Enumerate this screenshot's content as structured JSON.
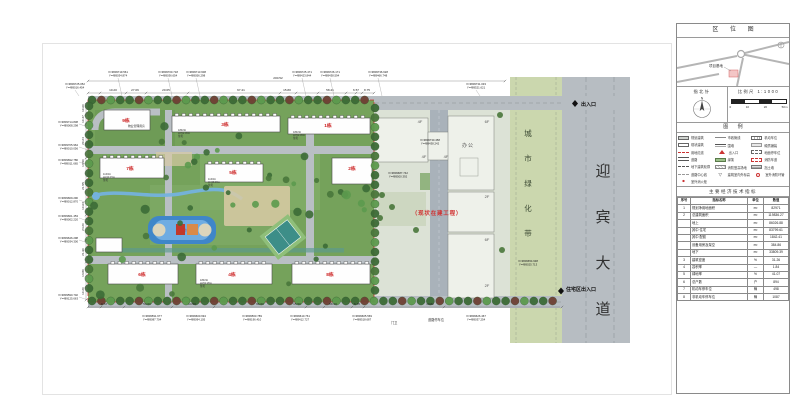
{
  "colors": {
    "site_green": "#75a25b",
    "site_green_light": "#86b16d",
    "road_gray": "#b7bdc2",
    "belt_green": "#cbd7ae",
    "exist_bg": "#dce2d6",
    "exist_bldg": "#eef1ea",
    "water_blue": "#3f86c9",
    "water_light": "#6face2",
    "court_teal": "#3d8e88",
    "court_green": "#8fbf7a",
    "boundary_red": "#cc3333",
    "label_red": "#cc2222",
    "note_red": "#d03030",
    "building_white": "#fefefe",
    "plaza_tan": "#d9caa5",
    "stream_blue": "#74b2de",
    "tree_dark": "#3c6b36",
    "tree_mid": "#49773b",
    "tree_light": "#5c9a4e",
    "tree_maroon": "#6e4034"
  },
  "titleblock": {
    "location_map_title": "区 位 图",
    "site_marker_label": "项目基地",
    "compass_title": "指北针",
    "north_letter": "N",
    "scale_title": "比例尺 1:1000",
    "scale_ticks": [
      "0",
      "10",
      "20",
      "50m"
    ],
    "legend_title": "图  例",
    "legend_columns": [
      [
        {
          "label": "规划建筑",
          "sym": "plan"
        },
        {
          "label": "现状建筑",
          "sym": "exist"
        },
        {
          "label": "用地红线",
          "sym": "redline"
        },
        {
          "label": "道路",
          "sym": "road"
        },
        {
          "label": "地下建筑轮廓",
          "sym": "under"
        },
        {
          "label": "道路中心线",
          "sym": "center"
        },
        {
          "label": "室外消火栓",
          "sym": "hydrant"
        }
      ],
      [
        {
          "label": "市政管线",
          "sym": "muni"
        },
        {
          "label": "围墙",
          "sym": "wall"
        },
        {
          "label": "出入口",
          "sym": "entry"
        },
        {
          "label": "绿篱",
          "sym": "hedge"
        },
        {
          "label": "消防登高场地",
          "sym": "fireground"
        },
        {
          "label": "建筑室内外标高",
          "sym": "level"
        }
      ],
      [
        {
          "label": "机动车位",
          "sym": "park"
        },
        {
          "label": "硬质铺装",
          "sym": "pave"
        },
        {
          "label": "地面停车位",
          "sym": "roadpark"
        },
        {
          "label": "消防车道",
          "sym": "firelane"
        },
        {
          "label": "挡土墙",
          "sym": "retain"
        },
        {
          "label": "室外消防环管",
          "sym": "ring"
        }
      ]
    ],
    "indicators_title": "主要经济技术指标",
    "indicators_header": [
      "序号",
      "指标名称",
      "单位",
      "数值"
    ],
    "indicators_rows": [
      [
        "1",
        "规划净用地面积",
        "m²",
        "82971"
      ],
      [
        "2",
        "总建筑面积",
        "m²",
        "119836.27"
      ],
      [
        "",
        "地上",
        "m²",
        "86026.88"
      ],
      [
        "",
        "其中 住宅",
        "m²",
        "83799.61"
      ],
      [
        "",
        "其中 配套",
        "m²",
        "1842.41"
      ],
      [
        "",
        "设备用房及架空",
        "m²",
        "384.86"
      ],
      [
        "",
        "地下",
        "m²",
        "33809.39"
      ],
      [
        "3",
        "建筑密度",
        "%",
        "31.26"
      ],
      [
        "4",
        "容积率",
        "—",
        "1.84"
      ],
      [
        "5",
        "绿地率",
        "%",
        "41.07"
      ],
      [
        "6",
        "总户数",
        "户",
        "894"
      ],
      [
        "7",
        "机动车停车位",
        "辆",
        "498"
      ],
      [
        "8",
        "非机动车停车位",
        "辆",
        "1087"
      ]
    ]
  },
  "plan": {
    "road_name_vertical": "迎宾大道",
    "green_belt_label": "城市绿化带",
    "entrance_top": "出入口",
    "entrance_bottom": "住宅区出入口",
    "construction_note": "（现状在建工程）",
    "office_label": "办公",
    "pool_label": "游泳池",
    "property_note": "物业管理用房",
    "guard_label": "门卫",
    "road_parking_label": "道路停车位",
    "building_labels": [
      {
        "text": "9栋",
        "x": 126,
        "y": 122
      },
      {
        "text": "3栋",
        "x": 225,
        "y": 126
      },
      {
        "text": "1栋",
        "x": 328,
        "y": 127
      },
      {
        "text": "7栋",
        "x": 130,
        "y": 170
      },
      {
        "text": "5栋",
        "x": 233,
        "y": 174
      },
      {
        "text": "2栋",
        "x": 352,
        "y": 170
      },
      {
        "text": "6栋",
        "x": 142,
        "y": 276
      },
      {
        "text": "4栋",
        "x": 232,
        "y": 276
      },
      {
        "text": "8栋",
        "x": 330,
        "y": 276
      }
    ],
    "floor_labels": [
      {
        "text": "4F",
        "x": 420,
        "y": 123
      },
      {
        "text": "4F",
        "x": 424,
        "y": 158
      },
      {
        "text": "4F",
        "x": 446,
        "y": 158
      },
      {
        "text": "6F",
        "x": 487,
        "y": 123
      },
      {
        "text": "2F",
        "x": 487,
        "y": 198
      },
      {
        "text": "6F",
        "x": 487,
        "y": 241
      },
      {
        "text": "2F",
        "x": 487,
        "y": 287
      }
    ],
    "info_labels": [
      {
        "x": 178,
        "y": 131,
        "lines": [
          "18F/1b",
          "H=52.45m",
          "住宅"
        ]
      },
      {
        "x": 293,
        "y": 133,
        "lines": [
          "18F/1b",
          "H=52.45m",
          "住宅"
        ]
      },
      {
        "x": 103,
        "y": 175,
        "lines": [
          "11F/1b",
          "H=33.15m",
          "住宅"
        ]
      },
      {
        "x": 208,
        "y": 180,
        "lines": [
          "11F/1b",
          "H=33.15m",
          "住宅"
        ]
      },
      {
        "x": 200,
        "y": 281,
        "lines": [
          "18F/1b",
          "H=52.45m",
          "住宅"
        ]
      }
    ],
    "dims_top": [
      {
        "t": "10.20",
        "x": 113
      },
      {
        "t": "27.06",
        "x": 135
      },
      {
        "t": "20.65",
        "x": 166
      },
      {
        "t": "67.41",
        "x": 241
      },
      {
        "t": "15.80",
        "x": 287
      },
      {
        "t": "58.41",
        "x": 330
      },
      {
        "t": "6.57",
        "x": 356
      },
      {
        "t": "8.75",
        "x": 367
      }
    ],
    "dims_overall": {
      "t": "200.52",
      "x": 278,
      "y": 79
    },
    "dims_bottom": [
      {
        "t": "9.72",
        "x": 104
      },
      {
        "t": "53.60",
        "x": 147
      },
      {
        "t": "14.50",
        "x": 192
      },
      {
        "t": "96.60",
        "x": 260
      },
      {
        "t": "15.50",
        "x": 297
      },
      {
        "t": "58.40",
        "x": 333
      },
      {
        "t": "6.70",
        "x": 357
      },
      {
        "t": "13.82",
        "x": 430
      }
    ],
    "dims_left": [
      {
        "t": "10.60",
        "y": 108
      },
      {
        "t": "10.47",
        "y": 119
      },
      {
        "t": "20.24",
        "y": 141
      },
      {
        "t": "13.50",
        "y": 163
      },
      {
        "t": "21.55",
        "y": 186
      },
      {
        "t": "10.63",
        "y": 206
      },
      {
        "t": "24.20",
        "y": 227
      },
      {
        "t": "21.90",
        "y": 252
      },
      {
        "t": "13.80",
        "y": 273
      },
      {
        "t": "10.20",
        "y": 291
      }
    ],
    "coords_top": [
      {
        "x": 75,
        "y": 85,
        "xl": "X=3809725.052",
        "yl": "Y=489016.454"
      },
      {
        "x": 118,
        "y": 73,
        "xl": "X=3809719.561",
        "yl": "Y=489034.874"
      },
      {
        "x": 168,
        "y": 73,
        "xl": "X=3809700.718",
        "yl": "Y=489036.654"
      },
      {
        "x": 196,
        "y": 73,
        "xl": "X=3809713.608",
        "yl": "Y=489056.298"
      },
      {
        "x": 302,
        "y": 73,
        "xl": "X=3809725.471",
        "yl": "Y=489423.844"
      },
      {
        "x": 330,
        "y": 73,
        "xl": "X=3809726.171",
        "yl": "Y=489438.594"
      },
      {
        "x": 378,
        "y": 73,
        "xl": "X=3809736.628",
        "yl": "Y=489466.748"
      },
      {
        "x": 476,
        "y": 85,
        "xl": "X=3809731.033",
        "yl": "Y=489521.621"
      }
    ],
    "coords_left": [
      {
        "y": 123,
        "xl": "X=3809714.838",
        "yl": "Y=489008.298"
      },
      {
        "y": 146,
        "xl": "X=3809705.964",
        "yl": "Y=489010.056"
      },
      {
        "y": 161,
        "xl": "X=3809692.786",
        "yl": "Y=489011.665"
      },
      {
        "y": 199,
        "xl": "X=3809669.290",
        "yl": "Y=489012.870"
      },
      {
        "y": 217,
        "xl": "X=3809661.453",
        "yl": "Y=489002.220"
      },
      {
        "y": 239,
        "xl": "X=3809646.298",
        "yl": "Y=489034.300"
      },
      {
        "y": 296,
        "xl": "X=3809590.702",
        "yl": "Y=489125.663"
      }
    ],
    "coords_bottom": [
      {
        "x": 152,
        "y": 317,
        "xl": "X=3809591.677",
        "yl": "Y=489087.704"
      },
      {
        "x": 196,
        "y": 317,
        "xl": "X=3809600.694",
        "yl": "Y=489094.105"
      },
      {
        "x": 252,
        "y": 317,
        "xl": "X=3809563.789",
        "yl": "Y=489196.410"
      },
      {
        "x": 300,
        "y": 317,
        "xl": "X=3809610.761",
        "yl": "Y=489412.727"
      },
      {
        "x": 362,
        "y": 317,
        "xl": "X=3809605.569",
        "yl": "Y=489518.687"
      },
      {
        "x": 476,
        "y": 317,
        "xl": "X=3809626.467",
        "yl": "Y=489037.254"
      }
    ],
    "coords_inner": [
      {
        "x": 430,
        "y": 141,
        "xl": "X=3809730.458",
        "yl": "Y=489438.242"
      },
      {
        "x": 398,
        "y": 174,
        "xl": "X=3809687.742",
        "yl": "Y=489500.392"
      },
      {
        "x": 528,
        "y": 262,
        "xl": "X=3809654.938",
        "yl": "Y=489025.713"
      }
    ]
  }
}
